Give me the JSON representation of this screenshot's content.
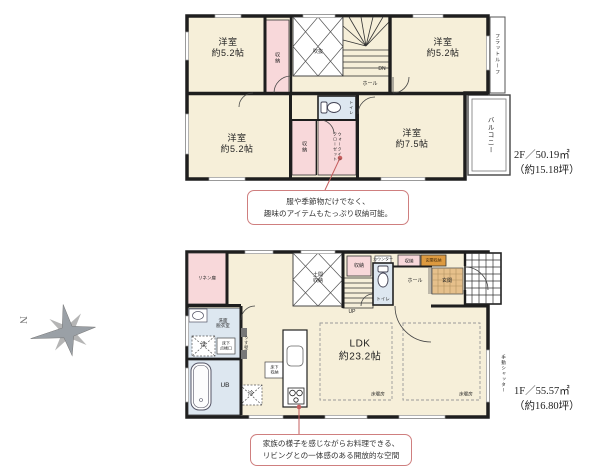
{
  "colors": {
    "wall": "#1e1e1e",
    "room_fill": "#f6efd9",
    "closet_pink": "#f8d8da",
    "wet_blue": "#dde7f0",
    "genkan_tan": "#e6c08b",
    "entry_storage_orange": "#dd9a3f",
    "callout_border": "#cf7f7f",
    "leader": "#c65f5f",
    "compass_gray": "#9aa0a6"
  },
  "compass": {
    "north_label": "N"
  },
  "floor2": {
    "bedroom_top_left": "洋室\n約5.2帖",
    "bedroom_top_right": "洋室\n約5.2帖",
    "bedroom_mid_left": "洋室\n約5.2帖",
    "bedroom_mid_right": "洋室\n約7.5帖",
    "closet_top": "収納",
    "closet_mid": "収納",
    "walk_in_closet": "ウォークイン\nクローゼット",
    "void": "吹抜",
    "stairs_down": "DN",
    "hall": "ホール",
    "toilet": "トイレ",
    "flat_roof": "フラットルーフ",
    "balcony": "バルコニー",
    "area": "2F／50.19㎡\n（約15.18坪）",
    "callout": "服や季節物だけでなく、\n趣味のアイテムもたっぷり収納可能。"
  },
  "floor1": {
    "linen": "リネン庫",
    "doma_storage": "土間\n収納",
    "closet_stairs": "収納",
    "counter": "カウンター",
    "toilet": "トイレ",
    "closet_hall": "収納",
    "entry_storage": "玄関収納",
    "hall": "ホール",
    "genkan": "玄関",
    "stairs_up": "UP",
    "washroom": "洗面\n脱衣室",
    "washer": "洗",
    "underfloor_hatch": "床下\n点検口",
    "unit_bath": "UB",
    "thin_wall": "うす壁",
    "fridge": "冷",
    "underfloor_storage": "床下\n収納",
    "ldk": "LDK\n約23.2帖",
    "floor_heating_left": "床暖房",
    "floor_heating_right": "床暖房",
    "manual_shutter": "手動シャッター",
    "area": "1F／55.57㎡\n（約16.80坪）",
    "callout": "家族の様子を感じながらお料理できる、\nリビングとの一体感のある開放的な空間"
  }
}
